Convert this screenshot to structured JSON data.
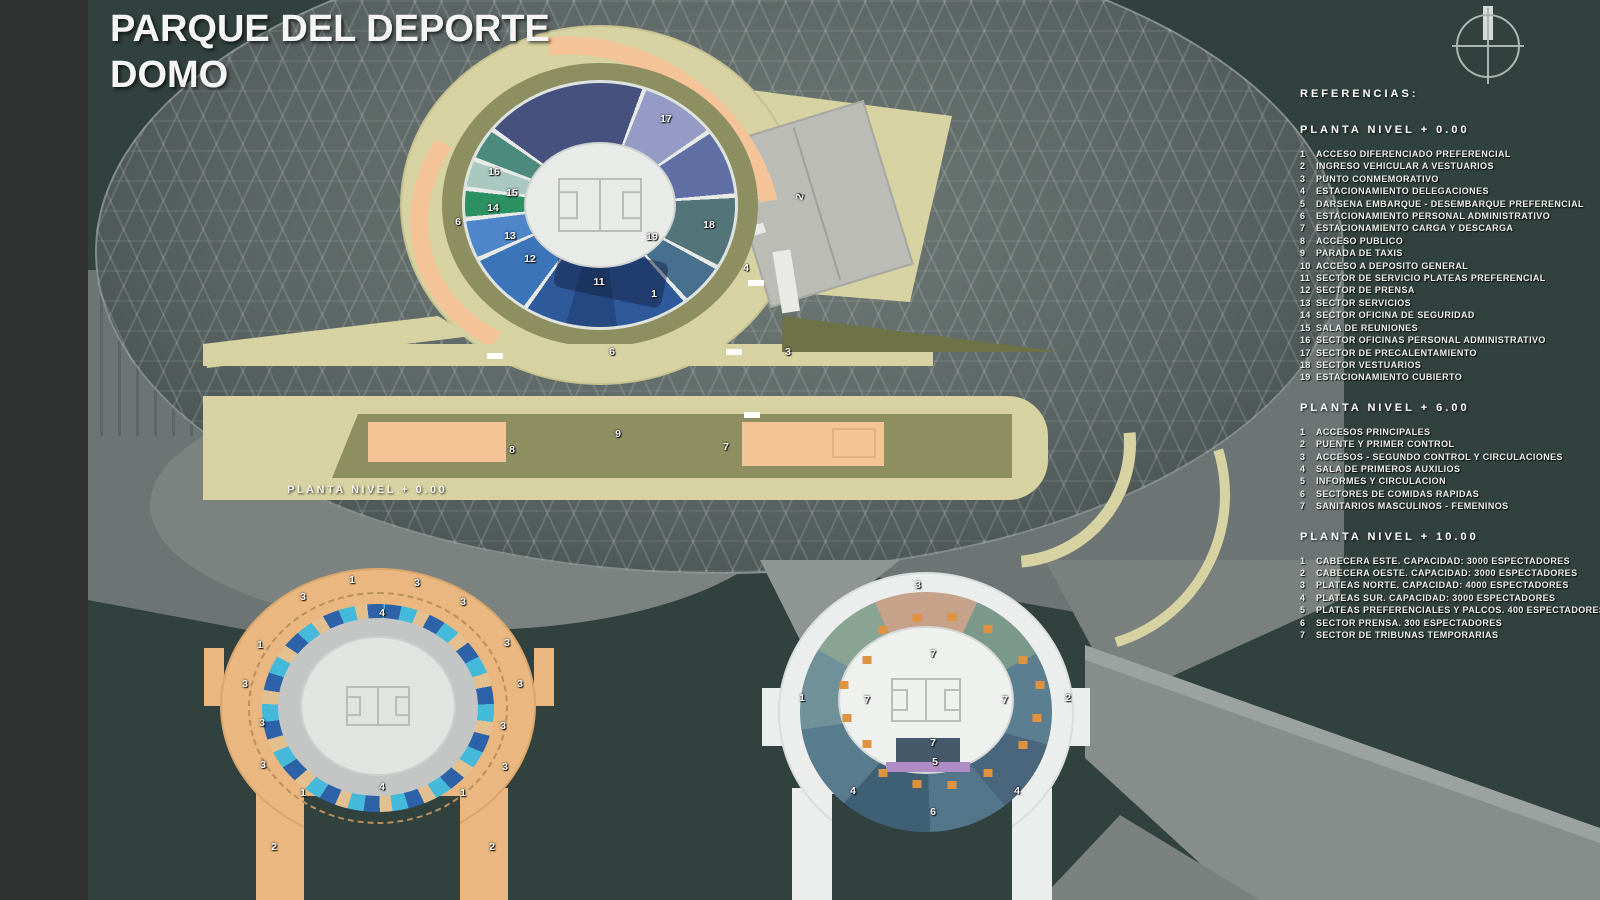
{
  "title": {
    "line1": "PARQUE DEL DEPORTE",
    "line2": "DOMO"
  },
  "references": {
    "title": "REFERENCIAS:",
    "sections": [
      {
        "heading": "PLANTA NIVEL + 0.00",
        "items": [
          {
            "n": "1",
            "text": "ACCESO DIFERENCIADO PREFERENCIAL"
          },
          {
            "n": "2",
            "text": "INGRESO VEHICULAR A VESTUARIOS"
          },
          {
            "n": "3",
            "text": "PUNTO CONMEMORATIVO"
          },
          {
            "n": "4",
            "text": "ESTACIONAMIENTO DELEGACIONES"
          },
          {
            "n": "5",
            "text": "DARSENA EMBARQUE - DESEMBARQUE PREFERENCIAL"
          },
          {
            "n": "6",
            "text": "ESTACIONAMIENTO PERSONAL ADMINISTRATIVO"
          },
          {
            "n": "7",
            "text": "ESTACIONAMIENTO CARGA Y DESCARGA"
          },
          {
            "n": "8",
            "text": "ACCESO PUBLICO"
          },
          {
            "n": "9",
            "text": "PARADA DE TAXIS"
          },
          {
            "n": "10",
            "text": "ACCESO A DEPOSITO GENERAL"
          },
          {
            "n": "11",
            "text": "SECTOR DE SERVICIO PLATEAS PREFERENCIAL"
          },
          {
            "n": "12",
            "text": "SECTOR DE PRENSA"
          },
          {
            "n": "13",
            "text": "SECTOR SERVICIOS"
          },
          {
            "n": "14",
            "text": "SECTOR OFICINA DE SEGURIDAD"
          },
          {
            "n": "15",
            "text": "SALA DE REUNIONES"
          },
          {
            "n": "16",
            "text": "SECTOR OFICINAS PERSONAL ADMINISTRATIVO"
          },
          {
            "n": "17",
            "text": "SECTOR DE PRECALENTAMIENTO"
          },
          {
            "n": "18",
            "text": "SECTOR VESTUARIOS"
          },
          {
            "n": "19",
            "text": "ESTACIONAMIENTO CUBIERTO"
          }
        ]
      },
      {
        "heading": "PLANTA NIVEL + 6.00",
        "items": [
          {
            "n": "1",
            "text": "ACCESOS PRINCIPALES"
          },
          {
            "n": "2",
            "text": "PUENTE Y PRIMER CONTROL"
          },
          {
            "n": "3",
            "text": "ACCESOS - SEGUNDO CONTROL Y CIRCULACIONES"
          },
          {
            "n": "4",
            "text": "SALA DE PRIMEROS AUXILIOS"
          },
          {
            "n": "5",
            "text": "INFORMES Y CIRCULACION"
          },
          {
            "n": "6",
            "text": "SECTORES DE COMIDAS RAPIDAS"
          },
          {
            "n": "7",
            "text": "SANITARIOS MASCULINOS - FEMENINOS"
          }
        ]
      },
      {
        "heading": "PLANTA NIVEL + 10.00",
        "items": [
          {
            "n": "1",
            "text": "CABECERA ESTE.  CAPACIDAD: 3000 ESPECTADORES"
          },
          {
            "n": "2",
            "text": "CABECERA OESTE. CAPACIDAD: 3000 ESPECTADORES"
          },
          {
            "n": "3",
            "text": "PLATEAS NORTE.  CAPACIDAD: 4000 ESPECTADORES"
          },
          {
            "n": "4",
            "text": "PLATEAS SUR. CAPACIDAD: 3000 ESPECTADORES"
          },
          {
            "n": "5",
            "text": "PLATEAS PREFERENCIALES Y PALCOS. 400 ESPECTADORES"
          },
          {
            "n": "6",
            "text": "SECTOR PRENSA. 300 ESPECTADORES"
          },
          {
            "n": "7",
            "text": "SECTOR DE TRIBUNAS TEMPORARIAS"
          }
        ]
      }
    ]
  },
  "plans": {
    "main": {
      "caption": "PLANTA NIVEL + 0.00",
      "markers": [
        {
          "t": "17",
          "x": 666,
          "y": 119
        },
        {
          "t": "16",
          "x": 494,
          "y": 172
        },
        {
          "t": "15",
          "x": 512,
          "y": 193
        },
        {
          "t": "14",
          "x": 493,
          "y": 208
        },
        {
          "t": "13",
          "x": 510,
          "y": 236
        },
        {
          "t": "12",
          "x": 530,
          "y": 259
        },
        {
          "t": "11",
          "x": 599,
          "y": 282
        },
        {
          "t": "19",
          "x": 652,
          "y": 237
        },
        {
          "t": "18",
          "x": 709,
          "y": 225
        },
        {
          "t": "1",
          "x": 654,
          "y": 294
        },
        {
          "t": "4",
          "x": 746,
          "y": 268
        },
        {
          "t": "2",
          "x": 800,
          "y": 197,
          "r": -72
        },
        {
          "t": "6",
          "x": 458,
          "y": 222
        },
        {
          "t": "6",
          "x": 612,
          "y": 352
        },
        {
          "t": "3",
          "x": 788,
          "y": 352
        },
        {
          "t": "9",
          "x": 618,
          "y": 434
        },
        {
          "t": "8",
          "x": 512,
          "y": 450
        },
        {
          "t": "7",
          "x": 726,
          "y": 447
        }
      ]
    },
    "level6": {
      "markers": [
        {
          "t": "4",
          "x": 382,
          "y": 613
        },
        {
          "t": "3",
          "x": 303,
          "y": 597
        },
        {
          "t": "3",
          "x": 417,
          "y": 583
        },
        {
          "t": "1",
          "x": 352,
          "y": 580
        },
        {
          "t": "3",
          "x": 463,
          "y": 602
        },
        {
          "t": "3",
          "x": 507,
          "y": 643
        },
        {
          "t": "3",
          "x": 245,
          "y": 684
        },
        {
          "t": "3",
          "x": 520,
          "y": 684
        },
        {
          "t": "1",
          "x": 260,
          "y": 645
        },
        {
          "t": "3",
          "x": 262,
          "y": 723
        },
        {
          "t": "3",
          "x": 503,
          "y": 726
        },
        {
          "t": "3",
          "x": 263,
          "y": 765
        },
        {
          "t": "3",
          "x": 505,
          "y": 767
        },
        {
          "t": "1",
          "x": 303,
          "y": 793
        },
        {
          "t": "1",
          "x": 463,
          "y": 793
        },
        {
          "t": "4",
          "x": 382,
          "y": 787
        },
        {
          "t": "2",
          "x": 274,
          "y": 847
        },
        {
          "t": "2",
          "x": 492,
          "y": 847
        }
      ]
    },
    "level10": {
      "markers": [
        {
          "t": "3",
          "x": 918,
          "y": 585
        },
        {
          "t": "7",
          "x": 933,
          "y": 654
        },
        {
          "t": "1",
          "x": 802,
          "y": 698
        },
        {
          "t": "2",
          "x": 1068,
          "y": 698
        },
        {
          "t": "7",
          "x": 867,
          "y": 700
        },
        {
          "t": "7",
          "x": 1005,
          "y": 700
        },
        {
          "t": "7",
          "x": 933,
          "y": 743
        },
        {
          "t": "5",
          "x": 935,
          "y": 762
        },
        {
          "t": "4",
          "x": 853,
          "y": 791
        },
        {
          "t": "4",
          "x": 1017,
          "y": 791
        },
        {
          "t": "6",
          "x": 933,
          "y": 812
        }
      ]
    }
  },
  "icons": {
    "compass": "north-compass"
  },
  "colors": {
    "background": "#31413d",
    "side_bar": "#2f3231",
    "plaza_khaki": "#d7d2a1",
    "olive": "#8d8f60",
    "peach": "#f4c496",
    "parking_gray": "#bbbcb6",
    "dome_gray": "#5a6462",
    "level6_orange": "#e9b77f",
    "cyan": "#44b9d9",
    "royal_blue": "#2d62a8",
    "navy": "#47517e",
    "teal": "#537479",
    "green": "#2b9160",
    "level10_white": "#ebeeec",
    "accent_dot_orange": "#df9340",
    "text": "#eceee9"
  }
}
